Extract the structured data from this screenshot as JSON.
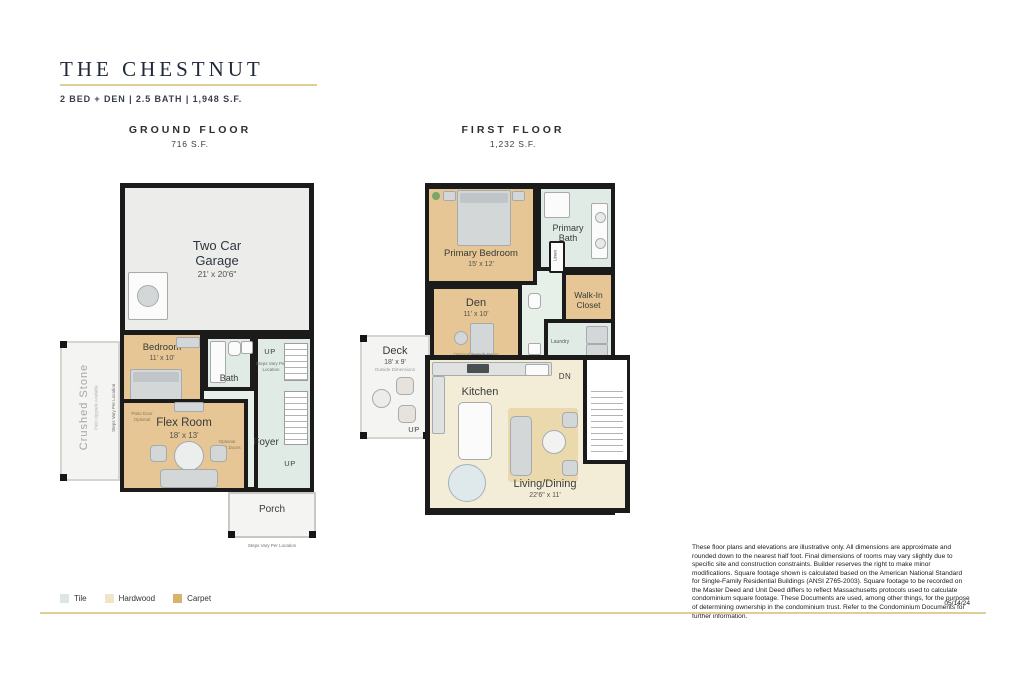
{
  "header": {
    "title": "THE CHESTNUT",
    "subtitle": "2 BED + DEN | 2.5 BATH | 1,948 S.F."
  },
  "ground": {
    "heading": "GROUND FLOOR",
    "area": "716 S.F.",
    "garage": {
      "label": "Two Car Garage",
      "dims": "21' x 20'6\""
    },
    "bedroom": {
      "label": "Bedroom",
      "dims": "11' x 10'"
    },
    "bath": {
      "label": "Bath"
    },
    "hall": {
      "up": "UP",
      "steps_note": "Steps Vary Per Location",
      "foyer": "Foyer"
    },
    "patio": {
      "label": "Crushed Stone",
      "note": "Patio Upgrade Available",
      "steps_note": "Steps Vary Per Location"
    },
    "flex": {
      "label": "Flex Room",
      "dims": "18' x 13'",
      "note_left": "Patio Door Optional",
      "note_right": "Optional French Doors"
    },
    "porch": {
      "label": "Porch",
      "steps_note": "Steps Vary Per Location"
    }
  },
  "first": {
    "heading": "FIRST FLOOR",
    "area": "1,232 S.F.",
    "primary_bedroom": {
      "label": "Primary Bedroom",
      "dims": "15' x 12'"
    },
    "primary_bath": {
      "label": "Primary Bath"
    },
    "linen": {
      "label": "Linen"
    },
    "walk_in": {
      "label": "Walk-In Closet"
    },
    "den": {
      "label": "Den",
      "dims": "11' x 10'",
      "note": "Optional French Doors"
    },
    "laundry": {
      "label": "Laundry"
    },
    "deck": {
      "label": "Deck",
      "dims": "18' x 9'",
      "note": "Outside Dimensions"
    },
    "kitchen": {
      "label": "Kitchen"
    },
    "living": {
      "label": "Living/Dining",
      "dims": "22'6\" x 11'"
    },
    "stairs": {
      "dn": "DN",
      "up": "UP"
    }
  },
  "legend": {
    "items": [
      {
        "label": "Tile",
        "color": "#dce6e2"
      },
      {
        "label": "Hardwood",
        "color": "#eee6c6"
      },
      {
        "label": "Carpet",
        "color": "#d7b36e"
      }
    ]
  },
  "footer": {
    "disclaimer": "These floor plans and elevations are illustrative only. All dimensions are approximate and rounded down to the nearest half foot. Final dimensions of rooms may vary slightly due to specific site and construction constraints. Builder reserves the right to make minor modifications. Square footage shown is calculated based on the American National Standard for Single-Family Residential Buildings (ANSI Z765-2003). Square footage to be recorded on the Master Deed and Unit Deed differs to reflect Massachusetts protocols used to calculate condominium square footage. These Documents are used, among other things, for the purpose of determining ownership in the condominium trust. Refer to the Condominium Documents for further information.",
    "date": "05/14/24"
  },
  "colors": {
    "wall": "#1b1b1b",
    "carpet": "#e5c694",
    "tile": "#e1ebe5",
    "hardwood": "#f3edd8",
    "concrete": "#ececea",
    "gold": "#ddcf96"
  }
}
